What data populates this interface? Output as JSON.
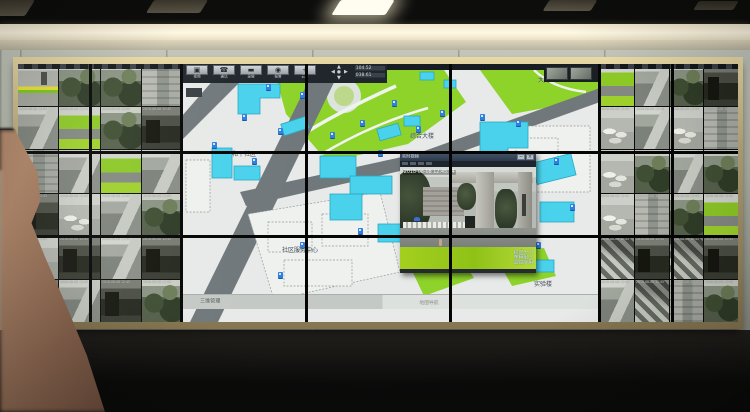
{
  "popup": {
    "title": "实时视频",
    "timestamp": "2018-08-08 12:45:04",
    "min_label": "─",
    "close_label": "×",
    "watermark": [
      "校区大门",
      "车辆出入",
      "监控专用"
    ]
  },
  "map": {
    "toolbar": {
      "buttons": [
        {
          "icon": "monitor-icon",
          "label": "视频"
        },
        {
          "icon": "phone-icon",
          "label": "通话"
        },
        {
          "icon": "record-icon",
          "label": "录像"
        },
        {
          "icon": "alarm-icon",
          "label": "报警"
        },
        {
          "icon": "ptz-icon",
          "label": "云台"
        }
      ],
      "status_lines": [
        "104.52",
        "038.61"
      ]
    },
    "tab_label": "三维管理",
    "bottom_label": "地图导航",
    "labels": [
      {
        "x": 50,
        "y": 88,
        "t": "和平社区"
      },
      {
        "x": 100,
        "y": 184,
        "t": "社区服务中心"
      },
      {
        "x": 330,
        "y": 128,
        "t": "东苑小区"
      },
      {
        "x": 356,
        "y": 14,
        "t": "大门"
      },
      {
        "x": 228,
        "y": 70,
        "t": "综合大楼"
      },
      {
        "x": 352,
        "y": 218,
        "t": "实验楼"
      }
    ],
    "cameras": [
      [
        84,
        20
      ],
      [
        118,
        28
      ],
      [
        60,
        50
      ],
      [
        96,
        64
      ],
      [
        30,
        78
      ],
      [
        70,
        94
      ],
      [
        148,
        68
      ],
      [
        178,
        56
      ],
      [
        234,
        62
      ],
      [
        196,
        86
      ],
      [
        258,
        46
      ],
      [
        298,
        50
      ],
      [
        334,
        56
      ],
      [
        372,
        94
      ],
      [
        388,
        140
      ],
      [
        354,
        178
      ],
      [
        176,
        164
      ],
      [
        118,
        178
      ],
      [
        96,
        208
      ],
      [
        262,
        148
      ],
      [
        210,
        36
      ],
      [
        246,
        92
      ]
    ],
    "thumbnails": [
      "camera-thumb-icon",
      "camera-thumb-icon"
    ]
  },
  "walls": {
    "timestamp_overlay": "2018-08-08 12:45",
    "left_tiles": [
      0,
      1,
      1,
      7,
      2,
      6,
      1,
      3,
      7,
      2,
      6,
      2,
      3,
      4,
      2,
      1,
      4,
      3,
      2,
      3,
      3,
      2,
      3,
      1
    ],
    "right_tiles": [
      6,
      2,
      1,
      3,
      4,
      2,
      4,
      7,
      4,
      1,
      2,
      1,
      4,
      7,
      1,
      6,
      5,
      3,
      5,
      3,
      2,
      5,
      7,
      1
    ]
  },
  "colors": {
    "map_green": "#8ed32a",
    "map_cyan": "#4ad2ec",
    "road_gray": "#71787c",
    "lawn_green": "#9fce1e",
    "banner_yellow": "#e8e432",
    "frame_gold": "#bfa87c",
    "camera_icon_blue": "#2e7fe0"
  }
}
